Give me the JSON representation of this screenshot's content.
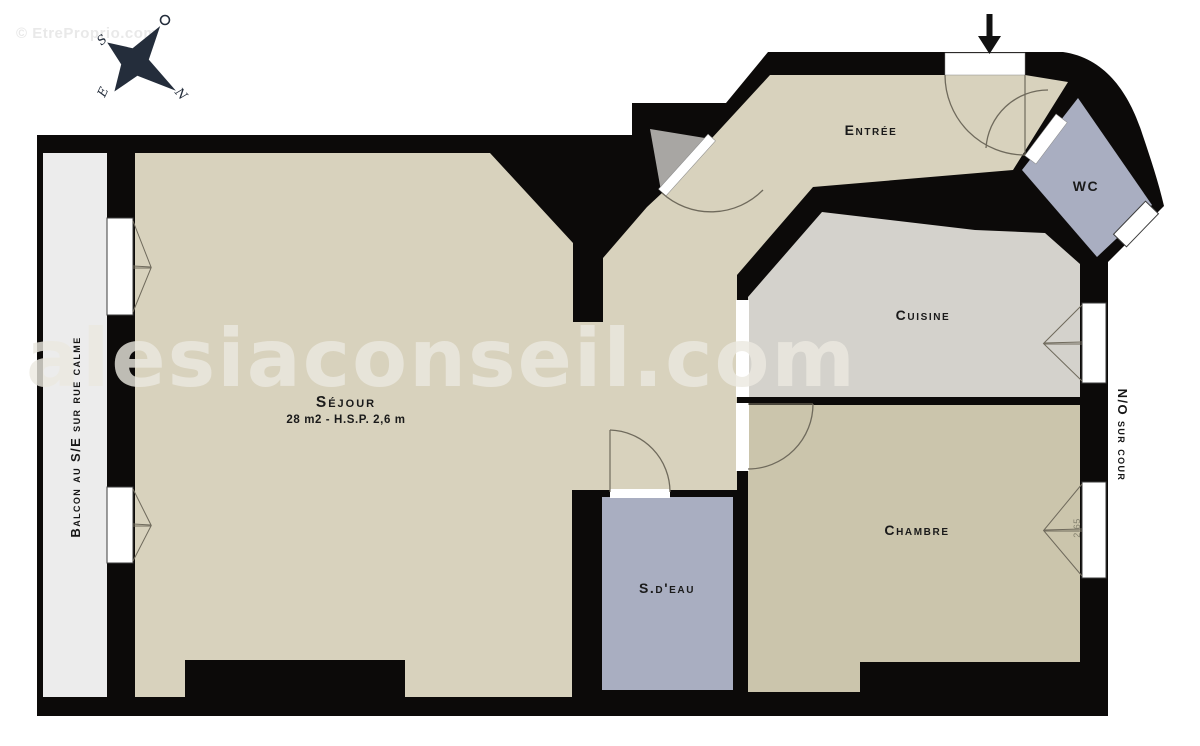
{
  "watermark": {
    "top_left": "© EtreProprio.com",
    "center": "alesiaconseil.com"
  },
  "compass": {
    "north": "N",
    "south": "S",
    "east": "E",
    "west": "O"
  },
  "rooms": [
    {
      "label": "Séjour",
      "details": "28 m2 - H.S.P. 2,6 m"
    },
    {
      "label": "Entrée"
    },
    {
      "label": "Cuisine"
    },
    {
      "label": "Chambre"
    },
    {
      "label": "S.d'eau"
    },
    {
      "label": "WC"
    }
  ],
  "annotations": {
    "balcony": "Balcon au S/E sur rue calme",
    "courtyard": "N/O sur cour",
    "window_dimension": "2,65"
  },
  "colors": {
    "wall": "#0c0a09",
    "floor_main": "#d8d2bd",
    "floor_bedroom": "#cbc5ac",
    "floor_kitchen": "#d4d2cc",
    "floor_wet": "#a9aec1",
    "closet": "#a8a6a3",
    "balcony": "#ececec",
    "white": "#ffffff",
    "compass": "#242d3b",
    "watermark_center": "rgba(235,232,224,0.8)",
    "watermark_corner": "#e9e9e9",
    "label": "#1a1a1a"
  }
}
